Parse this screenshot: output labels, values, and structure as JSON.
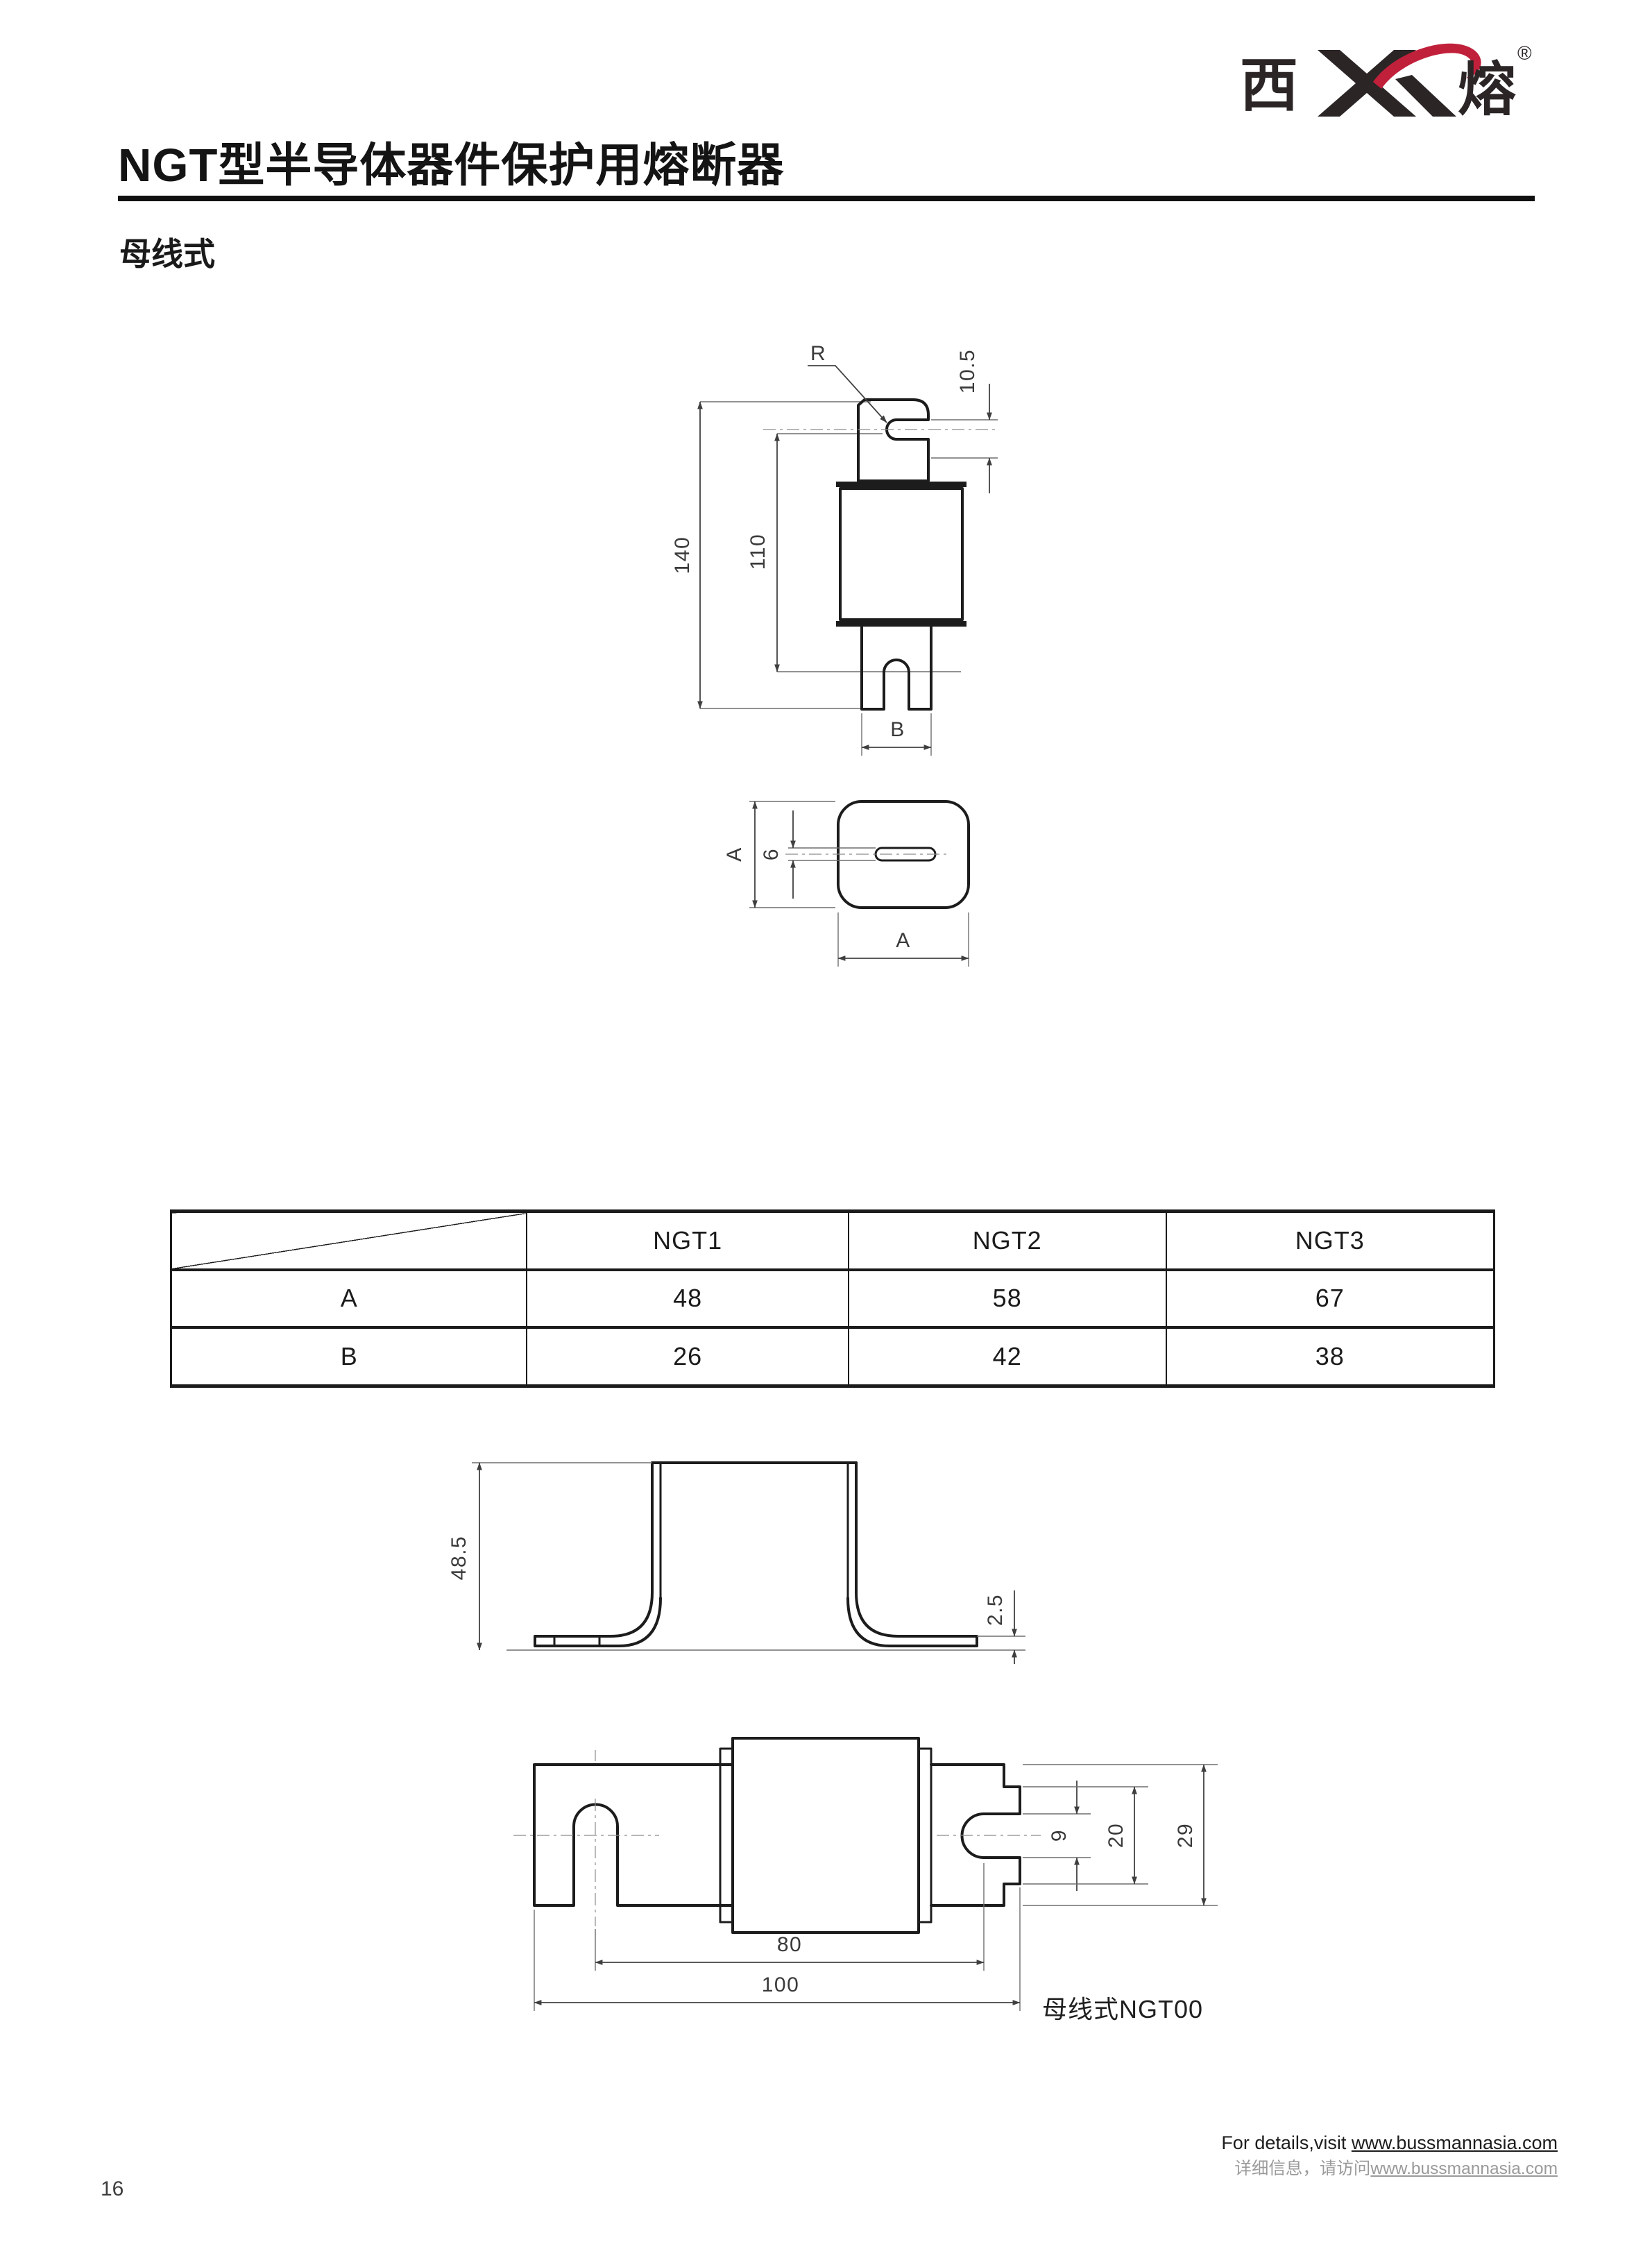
{
  "page": {
    "number": "16"
  },
  "logo": {
    "char_left": "西",
    "char_right": "熔",
    "registered": "®",
    "monogram": "XR",
    "ink_color": "#2b2526",
    "accent_color": "#c1203b"
  },
  "header": {
    "title": "NGT型半导体器件保护用熔断器",
    "subtitle": "母线式"
  },
  "figure1": {
    "labels": {
      "radius": "R",
      "slot_offset": "10.5",
      "overall_height": "140",
      "inner_height": "110",
      "blade_width": "B",
      "side_a": "A",
      "slot_width": "6",
      "bottom_a": "A"
    }
  },
  "table": {
    "col_headers": [
      "NGT1",
      "NGT2",
      "NGT3"
    ],
    "rows": [
      {
        "label": "A",
        "values": [
          "48",
          "58",
          "67"
        ]
      },
      {
        "label": "B",
        "values": [
          "26",
          "42",
          "38"
        ]
      }
    ]
  },
  "figure2": {
    "labels": {
      "height": "48.5",
      "foot_thickness": "2.5"
    }
  },
  "figure3": {
    "labels": {
      "slot": "9",
      "tab": "20",
      "blade_height": "29",
      "pitch": "80",
      "length": "100"
    },
    "caption": "母线式NGT00"
  },
  "footer": {
    "line1_prefix": "For details,visit ",
    "line1_url": "www.bussmannasia.com",
    "line2_prefix": "详细信息，请访问",
    "line2_url": "www.bussmannasia.com"
  }
}
